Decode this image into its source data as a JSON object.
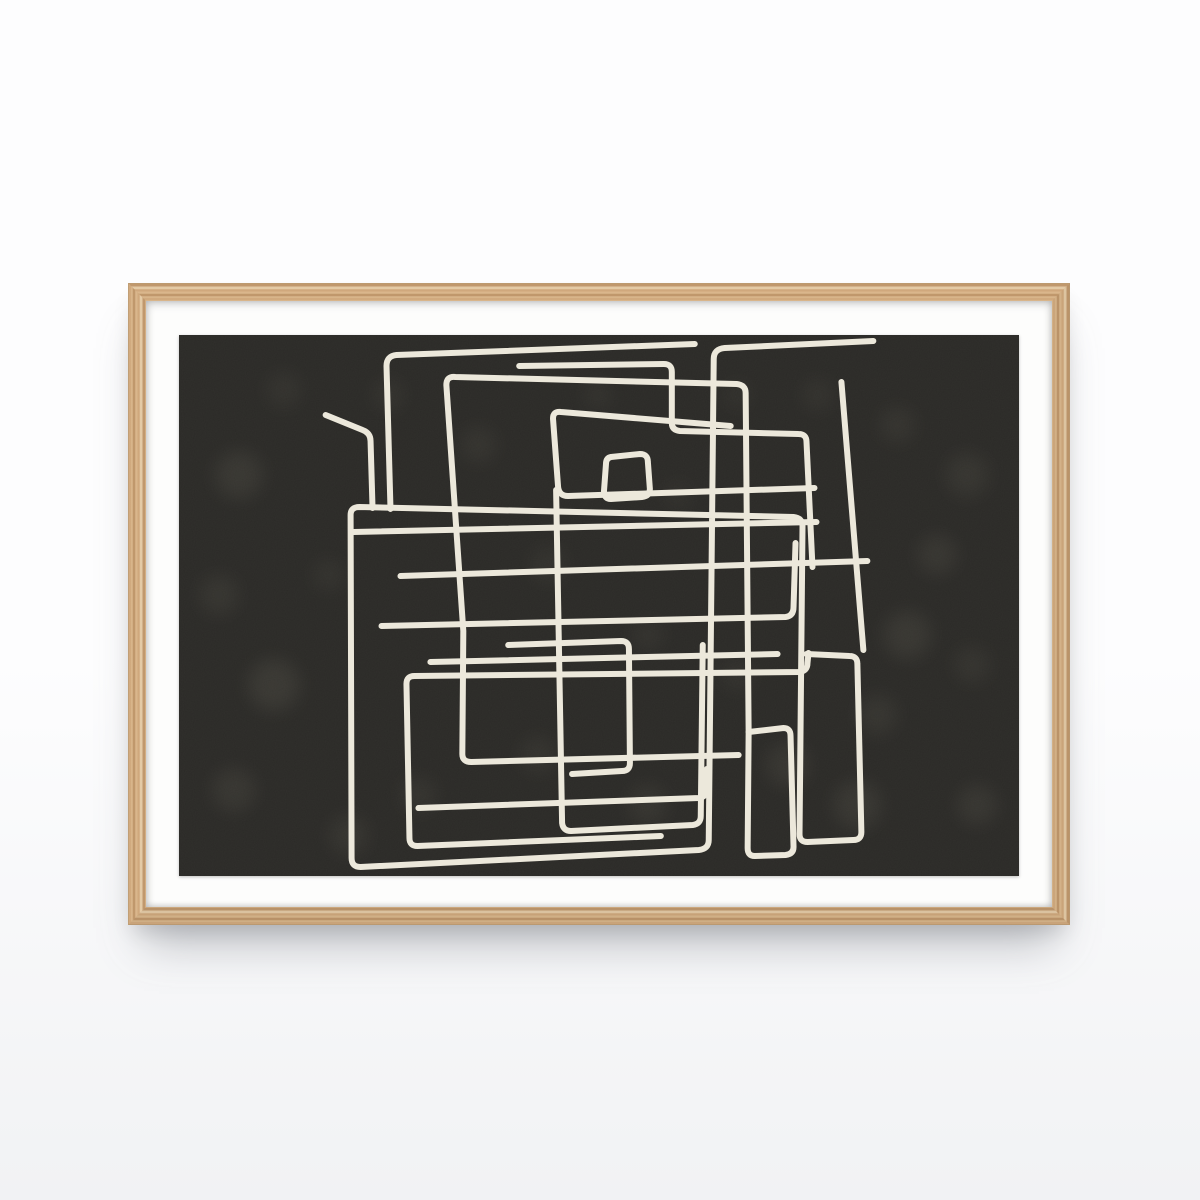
{
  "scene": {
    "description": "Product photo of a framed abstract poster: continuous off-white maze-like line art on a dark mottled charcoal background, white mat, light oak wood frame, hung on a white wall with a soft shadow below",
    "colors": {
      "wall_top": "#fdfdfe",
      "wall_bottom": "#f1f2f4",
      "shadow_strong": "rgba(105,110,120,0.42)",
      "shadow_soft": "rgba(0,0,0,0.14)"
    }
  },
  "frame": {
    "style": "light oak wood, mitred corners",
    "left": 128,
    "top": 283,
    "width": 942,
    "height": 642,
    "wood_thickness": 18,
    "colors": {
      "wood_light": "#dcba90",
      "wood_mid": "#cda579",
      "wood_dark": "#b78c60",
      "wood_highlight": "#ecd6b4"
    }
  },
  "mat": {
    "color": "#fdfdfc",
    "pad_top": 34,
    "pad_right": 33,
    "pad_bottom": 31,
    "pad_left": 33
  },
  "artwork": {
    "subject": "abstract rectilinear single-line maze drawing",
    "viewbox": "0 0 842 541",
    "background": "#2b2a27",
    "line_color": "#ece8db",
    "line_width": 6,
    "noise_opacity": 0.05,
    "spot_color": "#6b675c",
    "texture_spots": [
      [
        60,
        140,
        24,
        0.2
      ],
      [
        40,
        260,
        20,
        0.16
      ],
      [
        95,
        350,
        26,
        0.22
      ],
      [
        55,
        455,
        22,
        0.18
      ],
      [
        170,
        500,
        20,
        0.16
      ],
      [
        240,
        460,
        18,
        0.14
      ],
      [
        150,
        240,
        16,
        0.12
      ],
      [
        300,
        110,
        18,
        0.14
      ],
      [
        210,
        60,
        16,
        0.12
      ],
      [
        420,
        60,
        14,
        0.12
      ],
      [
        370,
        230,
        18,
        0.12
      ],
      [
        470,
        300,
        16,
        0.12
      ],
      [
        360,
        420,
        18,
        0.14
      ],
      [
        470,
        470,
        20,
        0.16
      ],
      [
        560,
        340,
        16,
        0.12
      ],
      [
        610,
        430,
        22,
        0.18
      ],
      [
        680,
        470,
        24,
        0.2
      ],
      [
        700,
        380,
        20,
        0.16
      ],
      [
        730,
        300,
        24,
        0.2
      ],
      [
        760,
        220,
        20,
        0.18
      ],
      [
        790,
        140,
        22,
        0.16
      ],
      [
        720,
        90,
        18,
        0.14
      ],
      [
        640,
        60,
        16,
        0.12
      ],
      [
        800,
        470,
        20,
        0.18
      ],
      [
        560,
        60,
        14,
        0.1
      ],
      [
        500,
        160,
        14,
        0.1
      ],
      [
        105,
        55,
        18,
        0.12
      ],
      [
        795,
        330,
        18,
        0.14
      ]
    ],
    "line_paths": [
      "M 147 80 L 184 95 Q 192 98 192 106 L 194 173",
      "M 212 174 L 208 31 Q 208 21 218 20 L 517 9",
      "M 696 6 L 547 13 Q 536 14 536 24 L 531 505 Q 531 514 521 515 L 182 532 Q 173 532 173 523 L 172 180 Q 172 172 181 172 L 616 182 Q 625 183 625 191 L 622 499 Q 622 507 630 507 L 676 505 Q 684 505 684 497 L 680 329 Q 680 321 672 321 L 629 319",
      "M 664 47 L 686 315",
      "M 571 397 L 568 58 Q 568 50 559 49 L 277 42 Q 268 41 268 50 L 285 296 L 284 419 Q 284 427 293 427 L 561 420",
      "M 571 397 L 606 393 Q 613 393 613 401 L 616 512 Q 616 519 608 520 L 577 521 Q 570 521 570 513 L 571 397",
      "M 341 31 L 486 29 Q 494 29 494 37 L 494 88 Q 494 95 502 96 L 621 99 Q 629 99 629 107 L 635 232",
      "M 637 153 L 390 161 Q 381 161 380 152 L 375 85 Q 374 76 383 77 L 553 91",
      "M 433 122 L 462 119 Q 470 119 470 127 L 472 154 Q 472 161 464 162 L 433 164 Q 426 164 426 156 L 428 129 Q 428 123 433 122",
      "M 483 501 L 239 511 Q 231 511 231 503 L 228 349 Q 228 341 236 341 L 622 337 Q 630 336 630 328 L 631 318",
      "M 175 197 L 639 187",
      "M 222 241 L 690 226",
      "M 203 291 L 608 282 Q 616 281 616 272 L 618 208",
      "M 240 473 L 521 463 Q 529 462 529 454 L 529 434",
      "M 378 155 L 384 488 Q 385 496 393 496 L 515 490 Q 523 489 523 481 L 525 310",
      "M 330 310 L 443 306 Q 451 306 451 314 L 452 428 Q 452 436 444 436 L 394 439",
      "M 252 327 L 600 319"
    ]
  }
}
